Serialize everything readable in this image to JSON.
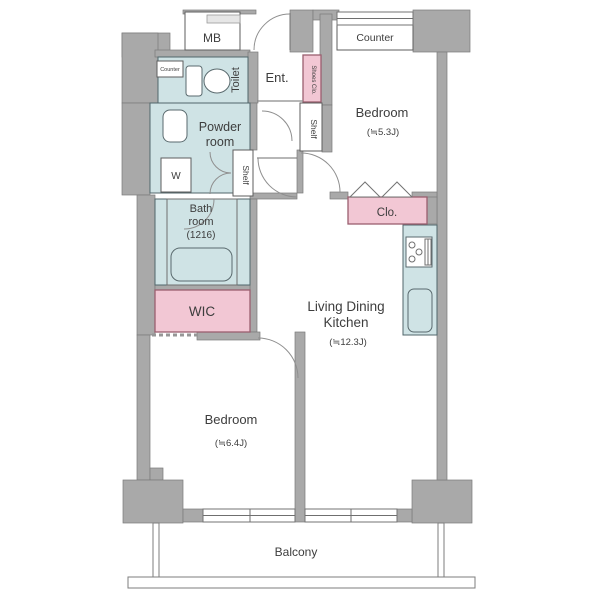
{
  "colors": {
    "wall": "#a9a9a9",
    "room_blue": "#cfe3e5",
    "room_pink": "#f2c7d4",
    "line": "#6f6f6f"
  },
  "rooms": {
    "mb": "MB",
    "toilet": "Toilet",
    "toilet_counter": "Counter",
    "entrance": "Ent.",
    "shoes_closet": "Shoes Clo.",
    "counter": "Counter",
    "bedroom1": {
      "name": "Bedroom",
      "size": "(≒5.3J)"
    },
    "shelf_hall": "Shelf",
    "shelf_powder": "Shelf",
    "powder": {
      "line1": "Powder",
      "line2": "room"
    },
    "washer": "W",
    "bath": {
      "line1": "Bath",
      "line2": "room",
      "line3": "(1216)"
    },
    "closet": "Clo.",
    "wic": "WIC",
    "ldk": {
      "line1": "Living Dining",
      "line2": "Kitchen",
      "size": "(≒12.3J)"
    },
    "bedroom2": {
      "name": "Bedroom",
      "size": "(≒6.4J)"
    },
    "balcony": "Balcony"
  }
}
